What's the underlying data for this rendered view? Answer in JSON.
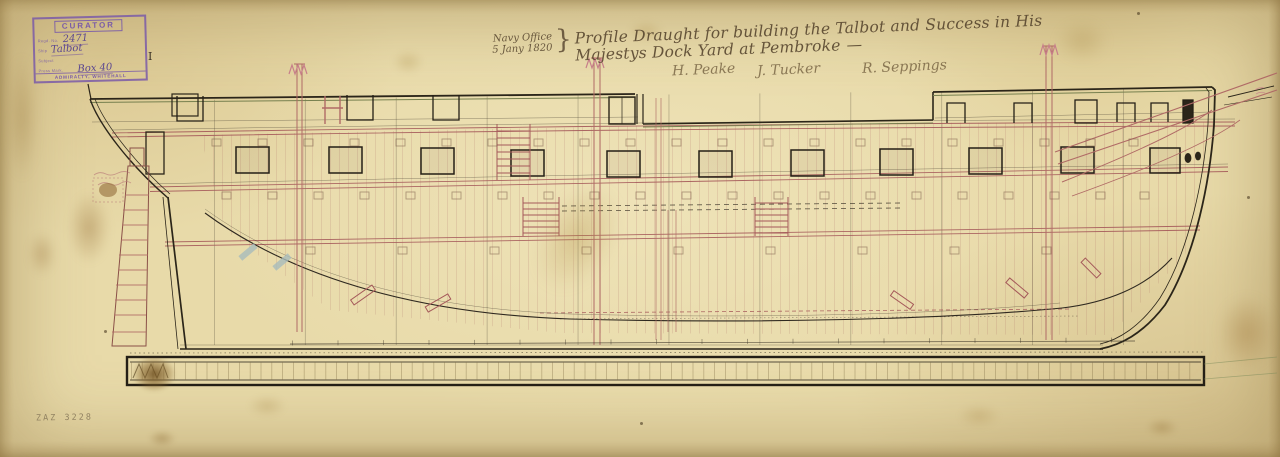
{
  "stamp": {
    "title": "CURATOR",
    "fields": [
      {
        "label": "Regd. No.",
        "value": "2471"
      },
      {
        "label": "Ship",
        "value": "Talbot"
      },
      {
        "label": "Subject",
        "value": ""
      },
      {
        "label": "Press Mark.",
        "value": "Box 40"
      }
    ],
    "press_mark_suffix": "I",
    "footer": "ADMIRALTY, WHITEHALL"
  },
  "title_block": {
    "office": "Navy Office",
    "date": "5 Jany 1820",
    "brace": "}",
    "title": "Profile Draught for building the Talbot and Success in His Majestys Dock Yard at Pembroke",
    "end_dash": "—"
  },
  "signatures": [
    {
      "name": "H. Peake"
    },
    {
      "name": "J. Tucker"
    },
    {
      "name": "R. Seppings"
    }
  ],
  "reference_number": "ZAZ 3228",
  "colors": {
    "paper": "#e8daa9",
    "ink_black": "#332c22",
    "ink_red": "#a5595a",
    "stamp_purple": "#7a5ba8",
    "pencil_gray": "#8a7b5c"
  }
}
